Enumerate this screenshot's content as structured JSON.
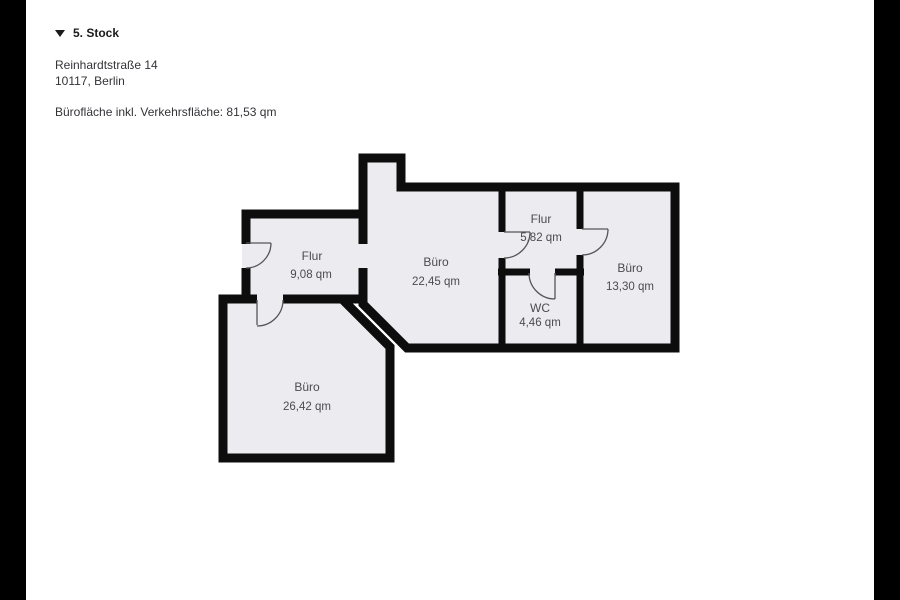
{
  "colors": {
    "letterbox": "#000000",
    "page_background": "#ffffff",
    "wall": "#0d0d0d",
    "room_fill": "#ececf0",
    "label_text": "#4c4c50",
    "header_text": "#1b1b1d"
  },
  "header": {
    "floor_label": "5. Stock",
    "address_line1": "Reinhardtstraße 14",
    "address_line2": "10117, Berlin",
    "area_summary": "Bürofläche inkl. Verkehrsfläche: 81,53 qm"
  },
  "floorplan": {
    "rooms": [
      {
        "id": "flur-left",
        "name": "Flur",
        "area": "9,08 qm"
      },
      {
        "id": "buero-center",
        "name": "Büro",
        "area": "22,45 qm"
      },
      {
        "id": "flur-right",
        "name": "Flur",
        "area": "5,82 qm"
      },
      {
        "id": "wc",
        "name": "WC",
        "area": "4,46 qm"
      },
      {
        "id": "buero-right",
        "name": "Büro",
        "area": "13,30 qm"
      },
      {
        "id": "buero-bottom",
        "name": "Büro",
        "area": "26,42 qm"
      }
    ]
  }
}
